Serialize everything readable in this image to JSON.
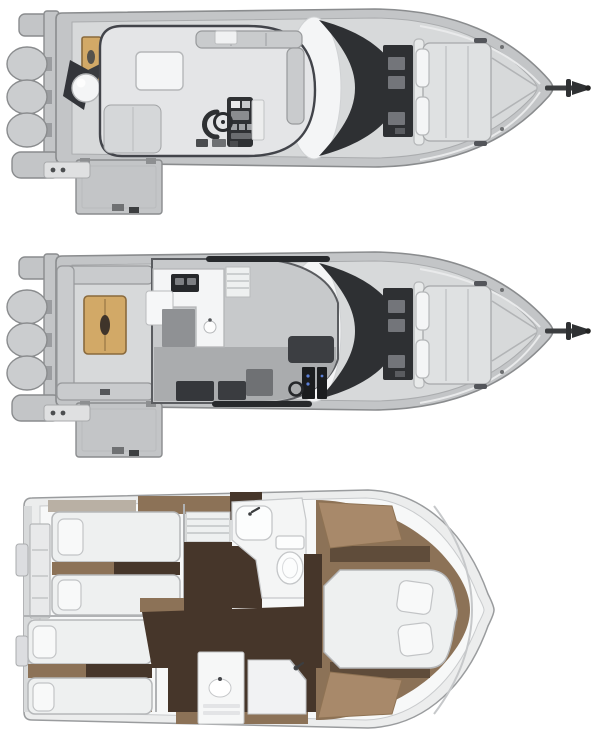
{
  "meta": {
    "title": "Motor yacht deck plans - top view of three decks"
  },
  "decks": [
    {
      "id": "flybridge-deck",
      "label": "Flybridge deck plan",
      "engines": 3
    },
    {
      "id": "main-deck",
      "label": "Main deck plan",
      "engines": 3
    },
    {
      "id": "lower-deck",
      "label": "Lower deck plan",
      "berths": 5,
      "bathrooms": 2
    }
  ],
  "colors": {
    "page_bg": "#ffffff",
    "hull_outline": "#8a8c8e",
    "hull_fill": "#c3c5c7",
    "engine_fill": "#cbcdcf",
    "deck_fill": "#d7d9da",
    "deck_stroke": "#aaacae",
    "lounge_fill": "#e4e5e7",
    "white": "#f4f5f6",
    "bench_fill": "#c9cbcd",
    "bench_stroke": "#97999b",
    "line_dark": "#2f3134",
    "glass_dark": "#2e3033",
    "teak": "#d2a967",
    "teak_dark": "#8a6a3c",
    "wood_mid": "#8c7257",
    "wood_dark": "#46362a",
    "wood_light": "#a8896a",
    "bed_fill": "#eef0f0",
    "bed_stroke": "#b5b7b9",
    "fixture_stroke": "#c4c6c8",
    "salon_floor": "#aaacae",
    "rail_dark": "#27292c",
    "accent_blue": "#5b7fd6"
  }
}
